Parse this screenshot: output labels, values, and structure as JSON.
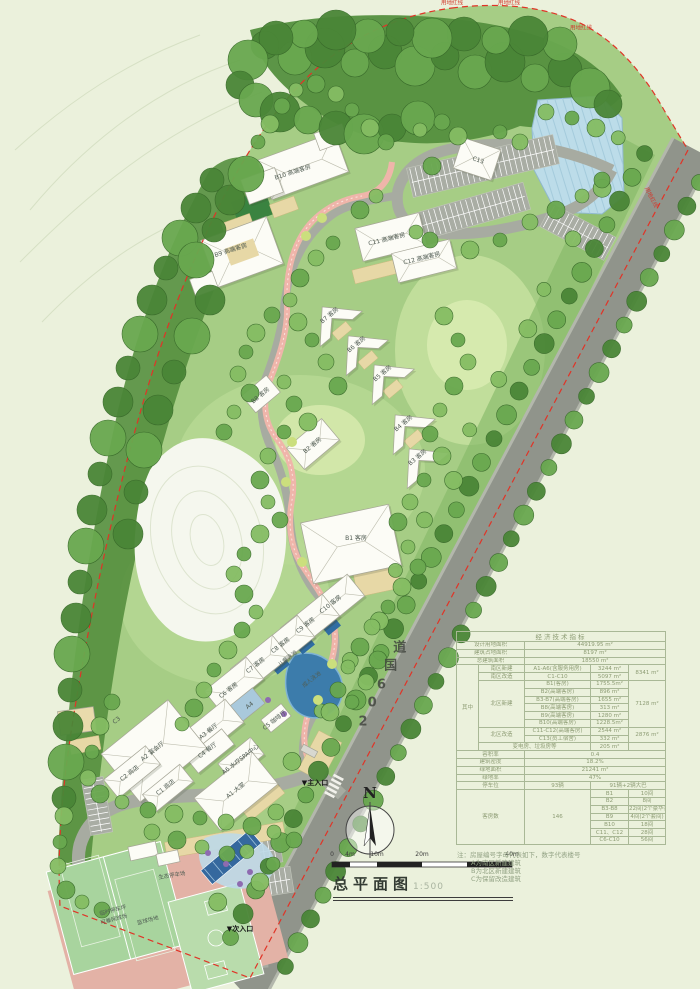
{
  "title": {
    "main": "总平面图",
    "scale": "1:500"
  },
  "north_label": "N",
  "road_name": "206国道",
  "boundary_label": "用地红线",
  "scale_bar": {
    "ticks": [
      {
        "t": "0",
        "x": 332
      },
      {
        "t": "4m",
        "x": 350
      },
      {
        "t": "10m",
        "x": 377
      },
      {
        "t": "20m",
        "x": 422
      },
      {
        "t": "40m",
        "x": 512
      }
    ]
  },
  "notes": {
    "intro": "注：房屋编号字母代表如下，数字代表楼号",
    "lines": [
      "A为南区新建建筑",
      "B为北区新建建筑",
      "C为保留改造建筑"
    ]
  },
  "entrances": [
    {
      "label": "▼主入口",
      "x": 315,
      "y": 783
    },
    {
      "label": "▼次入口",
      "x": 240,
      "y": 929
    }
  ],
  "building_labels": [
    {
      "t": "B10 高端客房",
      "x": 293,
      "y": 173,
      "r": -18
    },
    {
      "t": "B9 高端客房",
      "x": 231,
      "y": 251,
      "r": -18
    },
    {
      "t": "C13",
      "x": 478,
      "y": 161,
      "r": 18
    },
    {
      "t": "C11 高端客房",
      "x": 387,
      "y": 240,
      "r": -14
    },
    {
      "t": "C12 高端客房",
      "x": 422,
      "y": 259,
      "r": -14
    },
    {
      "t": "B7 客房",
      "x": 330,
      "y": 316,
      "r": -40
    },
    {
      "t": "B6 客房",
      "x": 357,
      "y": 345,
      "r": -40
    },
    {
      "t": "B5 客房",
      "x": 383,
      "y": 374,
      "r": -40
    },
    {
      "t": "B8 客房",
      "x": 261,
      "y": 396,
      "r": -40
    },
    {
      "t": "B4 客房",
      "x": 404,
      "y": 424,
      "r": -40
    },
    {
      "t": "B2 客房",
      "x": 313,
      "y": 446,
      "r": -40
    },
    {
      "t": "B3 客房",
      "x": 418,
      "y": 458,
      "r": -40
    },
    {
      "t": "B1 客房",
      "x": 356,
      "y": 539,
      "r": 0
    },
    {
      "t": "C10 客房",
      "x": 331,
      "y": 605,
      "r": -38
    },
    {
      "t": "C9 客房",
      "x": 306,
      "y": 626,
      "r": -38
    },
    {
      "t": "C8 客房",
      "x": 281,
      "y": 646,
      "r": -38
    },
    {
      "t": "C7 客房",
      "x": 256,
      "y": 666,
      "r": -38
    },
    {
      "t": "C6 客房",
      "x": 229,
      "y": 691,
      "r": -38
    },
    {
      "t": "A4",
      "x": 250,
      "y": 706,
      "r": -38
    },
    {
      "t": "C5 咖啡厅",
      "x": 275,
      "y": 721,
      "r": -38
    },
    {
      "t": "A3 餐厅",
      "x": 209,
      "y": 732,
      "r": -38
    },
    {
      "t": "C4 餐厅",
      "x": 208,
      "y": 751,
      "r": -38
    },
    {
      "t": "A6 水疗SPA中心",
      "x": 241,
      "y": 760,
      "r": -38
    },
    {
      "t": "A2 宴会厅",
      "x": 153,
      "y": 752,
      "r": -38
    },
    {
      "t": "C3",
      "x": 117,
      "y": 721,
      "r": -38
    },
    {
      "t": "A1 大堂",
      "x": 236,
      "y": 791,
      "r": -38
    },
    {
      "t": "C2 商店",
      "x": 130,
      "y": 774,
      "r": -38
    },
    {
      "t": "C1 商店",
      "x": 166,
      "y": 788,
      "r": -38
    }
  ],
  "site_labels": [
    {
      "t": "成人泳池",
      "x": 312,
      "y": 680,
      "r": -38
    },
    {
      "t": "儿童泳池",
      "x": 288,
      "y": 659,
      "r": -38
    },
    {
      "t": "生态停车场",
      "x": 172,
      "y": 876,
      "r": -9
    },
    {
      "t": "临时停车坪",
      "x": 113,
      "y": 911,
      "r": -15
    },
    {
      "t": "可兼网球场",
      "x": 114,
      "y": 920,
      "r": -15
    },
    {
      "t": "篮球场地",
      "x": 148,
      "y": 921,
      "r": -15
    }
  ],
  "table": {
    "rows": [
      [
        {
          "t": "经济技术指标",
          "cs": 5,
          "h": true
        }
      ],
      [
        {
          "t": "设计用地面积",
          "cs": 2
        },
        {
          "t": "44919.95 m²",
          "cs": 3
        }
      ],
      [
        {
          "t": "建筑占地面积",
          "cs": 2
        },
        {
          "t": "8197  m²",
          "cs": 3
        }
      ],
      [
        {
          "t": "总建筑面积",
          "cs": 2
        },
        {
          "t": "18550  m²",
          "cs": 3
        }
      ],
      [
        {
          "t": "其中",
          "rs": 11
        },
        {
          "t": "南区新建"
        },
        {
          "t": "A1-A6(含服务用房)"
        },
        {
          "t": "3244 m²"
        },
        {
          "t": "8341 m²",
          "rs": 2
        }
      ],
      [
        {
          "t": "南区改造"
        },
        {
          "t": "C1-C10"
        },
        {
          "t": "5097 m²"
        }
      ],
      [
        {
          "t": "北区新建",
          "rs": 6
        },
        {
          "t": "B1(客房)"
        },
        {
          "t": "1755.5m²"
        },
        {
          "t": "7128 m²",
          "rs": 6
        }
      ],
      [
        {
          "t": "B2(高端客房)"
        },
        {
          "t": "896  m²"
        }
      ],
      [
        {
          "t": "B3-B7(高端客房)"
        },
        {
          "t": "1655  m²"
        }
      ],
      [
        {
          "t": "B8(高端客房)"
        },
        {
          "t": "313  m²"
        }
      ],
      [
        {
          "t": "B9(高端客房)"
        },
        {
          "t": "1280  m²"
        }
      ],
      [
        {
          "t": "B10(高端客房)"
        },
        {
          "t": "1228.5m²"
        }
      ],
      [
        {
          "t": "北区改造",
          "rs": 2
        },
        {
          "t": "C11-C12(高端客房)"
        },
        {
          "t": "2544 m²"
        },
        {
          "t": "2876 m²",
          "rs": 2
        }
      ],
      [
        {
          "t": "C13(员工宿舍)"
        },
        {
          "t": "332  m²"
        }
      ],
      [
        {
          "t": "变电房、垃圾房等",
          "cs": 2
        },
        {
          "t": "205  m²"
        },
        {
          "t": ""
        }
      ],
      [
        {
          "t": "容积率",
          "cs": 2
        },
        {
          "t": "0.4",
          "cs": 3
        }
      ],
      [
        {
          "t": "建筑密度",
          "cs": 2
        },
        {
          "t": "18.2%",
          "cs": 3
        }
      ],
      [
        {
          "t": "绿地面积",
          "cs": 2
        },
        {
          "t": "21241  m²",
          "cs": 3
        }
      ],
      [
        {
          "t": "绿地率",
          "cs": 2
        },
        {
          "t": "47%",
          "cs": 3
        }
      ],
      [
        {
          "t": "停车位",
          "cs": 2
        },
        {
          "t": "93辆"
        },
        {
          "t": "91辆+2辆大巴",
          "cs": 2
        }
      ],
      [
        {
          "t": "客房数",
          "cs": 2,
          "rs": 7
        },
        {
          "t": "146",
          "rs": 7
        },
        {
          "t": "B1"
        },
        {
          "t": "10间"
        }
      ],
      [
        {
          "t": "B2"
        },
        {
          "t": "8间"
        }
      ],
      [
        {
          "t": "B3-B8"
        },
        {
          "t": "22间(2个豪华套间)"
        }
      ],
      [
        {
          "t": "B9"
        },
        {
          "t": "4间(2个套间)"
        }
      ],
      [
        {
          "t": "B10"
        },
        {
          "t": "18间"
        }
      ],
      [
        {
          "t": "C11、C12"
        },
        {
          "t": "28间"
        }
      ],
      [
        {
          "t": "C6-C10"
        },
        {
          "t": "56间"
        }
      ]
    ]
  }
}
